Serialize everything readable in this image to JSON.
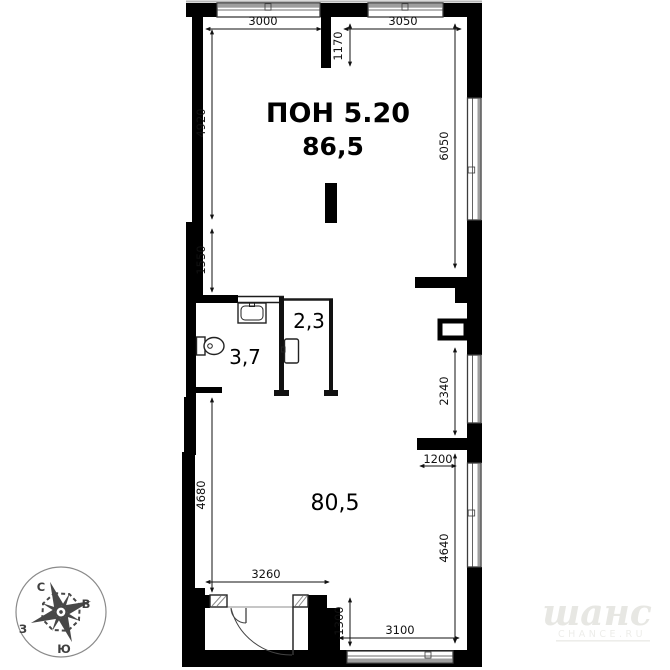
{
  "plan": {
    "unit_label": "ПОН 5.20",
    "unit_area": "86,5",
    "rooms": {
      "main": "80,5",
      "bath": "3,7",
      "small": "2,3"
    },
    "dims": {
      "top_left": "3000",
      "top_right": "3050",
      "top_niche": "1170",
      "left_upper": "4920",
      "left_mid": "1550",
      "left_lower": "4680",
      "right_upper": "6050",
      "right_window": "2340",
      "right_ledge": "1200",
      "right_lower": "4640",
      "bottom_inner": "3260",
      "entry_depth": "1300",
      "bottom_right": "3100"
    },
    "compass": {
      "north": "С",
      "east": "В",
      "south": "Ю",
      "west": "З"
    },
    "watermark": {
      "brand": "шанс",
      "site": "CHANCE.RU"
    },
    "colors": {
      "wall": "#000000",
      "dimension": "#111111",
      "window_band": "#9e9e9e",
      "watermark": "#e7e7e3"
    }
  }
}
